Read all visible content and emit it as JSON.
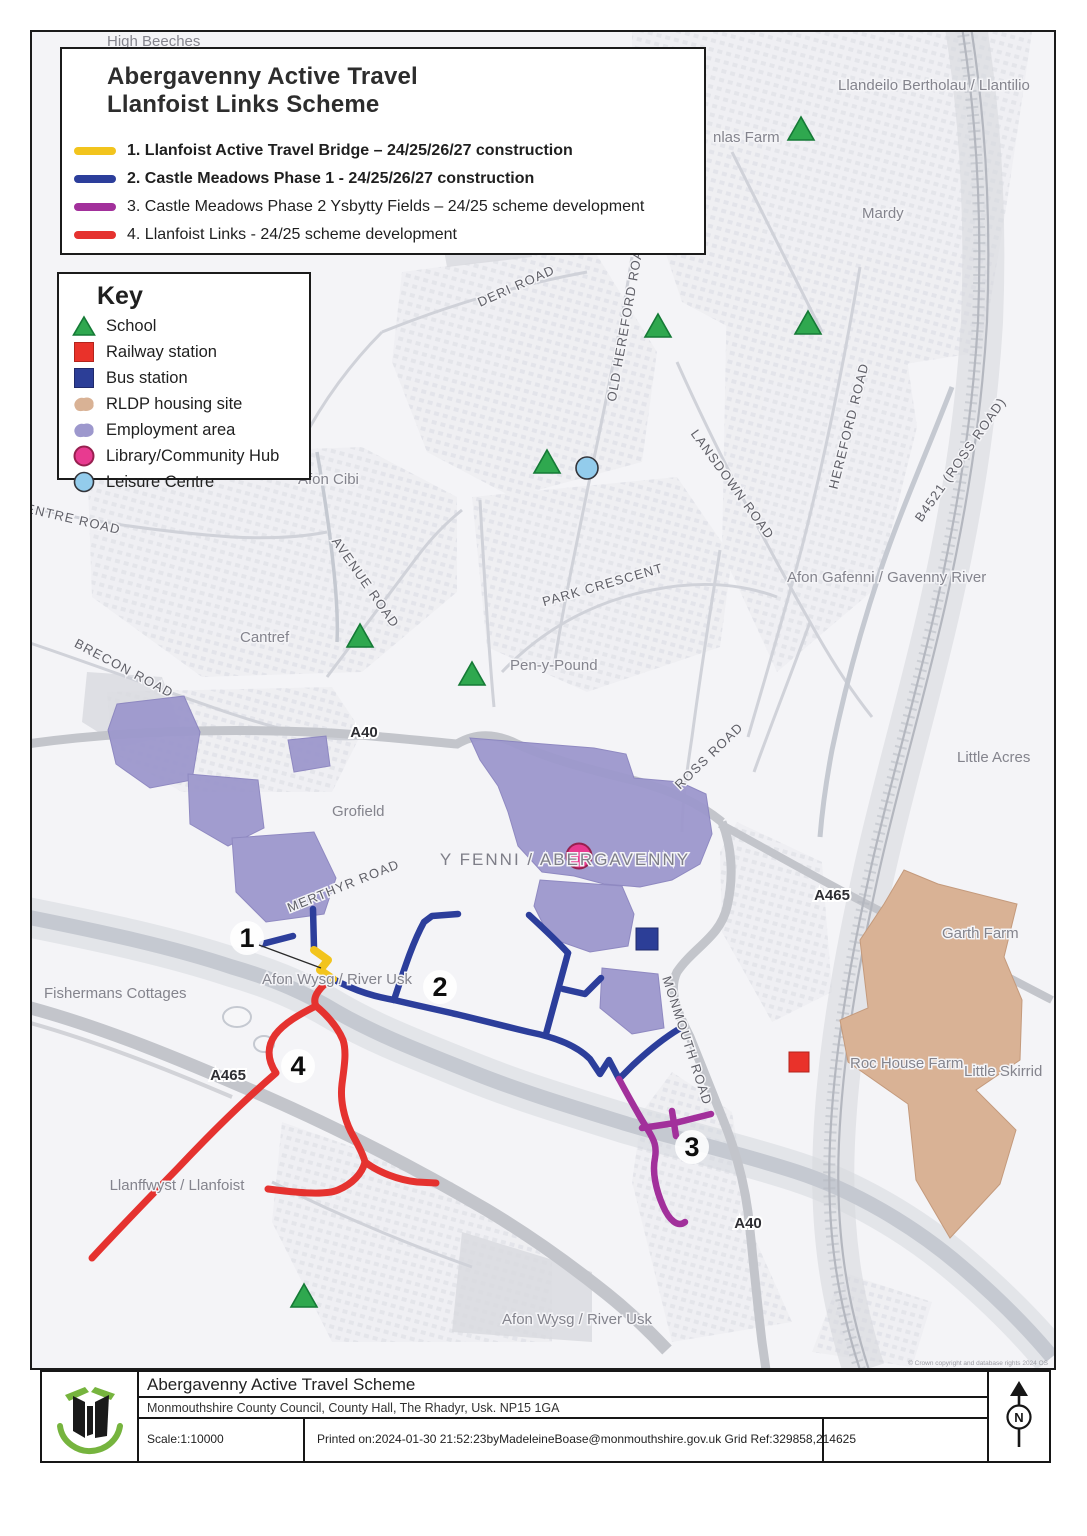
{
  "page": {
    "title_line1": "Abergavenny Active Travel",
    "title_line2": "Llanfoist Links Scheme"
  },
  "routes": [
    {
      "num": "1",
      "label": "1. Llanfoist Active Travel Bridge – 24/25/26/27 construction",
      "color": "#f2c41d",
      "bold": true
    },
    {
      "num": "2",
      "label": "2. Castle Meadows Phase 1 - 24/25/26/27 construction",
      "color": "#2c3e9b",
      "bold": true
    },
    {
      "num": "3",
      "label": "3. Castle Meadows Phase 2 Ysbytty Fields – 24/25 scheme development",
      "color": "#a2309b",
      "bold": false
    },
    {
      "num": "4",
      "label": "4. Llanfoist Links - 24/25 scheme development",
      "color": "#e5322f",
      "bold": false
    }
  ],
  "key": {
    "heading": "Key",
    "items": [
      {
        "icon": "school-triangle-icon",
        "label": "School",
        "color": "#2fa84f"
      },
      {
        "icon": "railway-station-icon",
        "label": "Railway station",
        "color": "#e9322a"
      },
      {
        "icon": "bus-station-icon",
        "label": "Bus station",
        "color": "#2c3e97"
      },
      {
        "icon": "rldp-housing-icon",
        "label": "RLDP housing site",
        "color": "#d9b295"
      },
      {
        "icon": "employment-area-icon",
        "label": "Employment area",
        "color": "#9d98cd"
      },
      {
        "icon": "library-hub-icon",
        "label": "Library/Community Hub",
        "color": "#e83a90"
      },
      {
        "icon": "leisure-centre-icon",
        "label": "Leisure Centre",
        "color": "#93ccec"
      }
    ]
  },
  "map": {
    "labels": [
      {
        "t": "High Beeches",
        "x": 75,
        "y": 14,
        "c": "place"
      },
      {
        "t": "nlas Farm",
        "x": 681,
        "y": 110,
        "c": "place"
      },
      {
        "t": "Llandeilo Bertholau / Llantilio",
        "x": 806,
        "y": 58,
        "c": "place"
      },
      {
        "t": "Mardy",
        "x": 830,
        "y": 186,
        "c": "place"
      },
      {
        "t": "DERI ROAD",
        "x": 486,
        "y": 258,
        "r": -24,
        "c": "road",
        "a": "middle"
      },
      {
        "t": "OLD HEREFORD ROAD",
        "x": 598,
        "y": 289,
        "r": -80,
        "c": "road",
        "a": "middle"
      },
      {
        "t": "LANSDOWN ROAD",
        "x": 697,
        "y": 455,
        "r": 54,
        "c": "road",
        "a": "middle"
      },
      {
        "t": "HEREFORD ROAD",
        "x": 821,
        "y": 395,
        "r": -76,
        "c": "road",
        "a": "middle"
      },
      {
        "t": "B4521 (ROSS ROAD)",
        "x": 932,
        "y": 430,
        "r": -55,
        "c": "road",
        "a": "middle"
      },
      {
        "t": "Afon Gafenni / Gavenny River",
        "x": 755,
        "y": 550,
        "c": "place"
      },
      {
        "t": "Little Acres",
        "x": 925,
        "y": 730,
        "c": "place"
      },
      {
        "t": "CENTRE ROAD",
        "x": 35,
        "y": 490,
        "r": 13,
        "c": "road",
        "a": "middle"
      },
      {
        "t": "Afon Cibi",
        "x": 266,
        "y": 452,
        "c": "place"
      },
      {
        "t": "AVENUE ROAD",
        "x": 330,
        "y": 553,
        "r": 55,
        "c": "road",
        "a": "middle"
      },
      {
        "t": "PARK CRESCENT",
        "x": 572,
        "y": 557,
        "r": -16,
        "c": "road",
        "a": "middle"
      },
      {
        "t": "Cantref",
        "x": 208,
        "y": 610,
        "c": "place"
      },
      {
        "t": "Pen-y-Pound",
        "x": 478,
        "y": 638,
        "c": "place"
      },
      {
        "t": "BRECON ROAD",
        "x": 90,
        "y": 640,
        "r": 28,
        "c": "road",
        "a": "middle"
      },
      {
        "t": "A40",
        "x": 332,
        "y": 705,
        "c": "aroad",
        "a": "middle"
      },
      {
        "t": "Grofield",
        "x": 300,
        "y": 784,
        "c": "place"
      },
      {
        "t": "ROSS ROAD",
        "x": 680,
        "y": 727,
        "r": -44,
        "c": "road",
        "a": "middle"
      },
      {
        "t": "Y FENNI / ABERGAVENNY",
        "x": 533,
        "y": 833,
        "c": "place-lg",
        "a": "middle"
      },
      {
        "t": "A465",
        "x": 800,
        "y": 868,
        "c": "aroad",
        "a": "middle"
      },
      {
        "t": "MERTHYR ROAD",
        "x": 313,
        "y": 858,
        "r": -22,
        "c": "road",
        "a": "middle"
      },
      {
        "t": "Garth Farm",
        "x": 910,
        "y": 906,
        "c": "place"
      },
      {
        "t": "Fishermans Cottages",
        "x": 12,
        "y": 966,
        "c": "place"
      },
      {
        "t": "Afon Wysg / River Usk",
        "x": 305,
        "y": 952,
        "c": "place",
        "a": "middle"
      },
      {
        "t": "MONMOUTH ROAD",
        "x": 651,
        "y": 1010,
        "r": 72,
        "c": "road",
        "a": "middle"
      },
      {
        "t": "Roc House Farm",
        "x": 818,
        "y": 1036,
        "c": "place"
      },
      {
        "t": "Little Skirrid",
        "x": 932,
        "y": 1044,
        "c": "place"
      },
      {
        "t": "A465",
        "x": 196,
        "y": 1048,
        "c": "aroad",
        "a": "middle"
      },
      {
        "t": "Llanffwyst / Llanfoist",
        "x": 145,
        "y": 1158,
        "c": "place",
        "a": "middle"
      },
      {
        "t": "A40",
        "x": 716,
        "y": 1196,
        "c": "aroad",
        "a": "middle"
      },
      {
        "t": "Afon Wysg / River Usk",
        "x": 545,
        "y": 1292,
        "c": "place",
        "a": "middle"
      },
      {
        "t": "1",
        "x": 215,
        "y": 915,
        "c": "num",
        "a": "middle"
      },
      {
        "t": "2",
        "x": 408,
        "y": 964,
        "c": "num",
        "a": "middle"
      },
      {
        "t": "3",
        "x": 660,
        "y": 1124,
        "c": "num",
        "a": "middle"
      },
      {
        "t": "4",
        "x": 266,
        "y": 1043,
        "c": "num",
        "a": "middle"
      },
      {
        "t": "© Crown copyright and database rights 2024 OS",
        "x": 1016,
        "y": 1333,
        "c": "tiny",
        "a": "end"
      }
    ]
  },
  "footer": {
    "scheme_title": "Abergavenny Active Travel Scheme",
    "address": "Monmouthshire County Council, County Hall, The Rhadyr, Usk. NP15 1GA",
    "scale": "Scale:1:10000",
    "printed": "Printed on:2024-01-30 21:52:23byMadeleineBoase@monmouthshire.gov.uk  Grid Ref:329858,214625",
    "north_letter": "N"
  }
}
